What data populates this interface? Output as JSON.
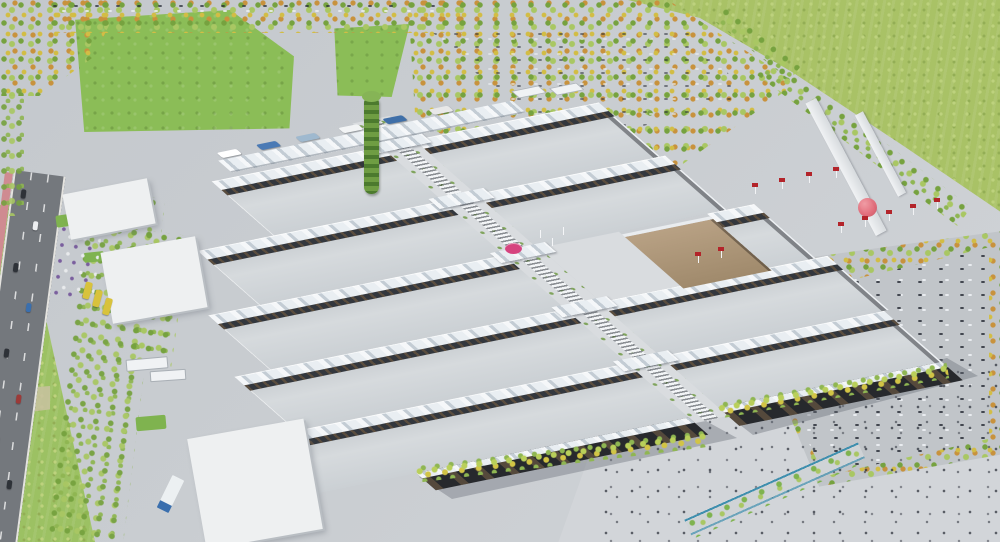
{
  "meta": {
    "type": "architectural aerial rendering",
    "subject": "Oblique aerial rendering of a large exhibition fairground: rows of flat-roofed halls with white wavy canopies along a diagonal central pedestrian spine, a green vertical-garden tower at the north entrance, bus terminal, tree-filled parking groves, access roads with a pink cycle lane, red flag banners and a pink sphere at the east entrance, large pedestrian plaza with people to the south-east, and surrounding green fields",
    "width_px": 1000,
    "height_px": 542
  },
  "palette": {
    "ground": "#c9cdd1",
    "ground_light": "#d2d5d9",
    "road": "#74787d",
    "road_edge": "#e4e3df",
    "bike": "#cf8b91",
    "field": "#a9c266",
    "field_light": "#bdd27d",
    "field_dark": "#93ae55",
    "field_west": "#9cc163",
    "dirt": "#c9c2a0",
    "lawn": "#8bbd57",
    "lawn_small": "#7fb34f",
    "tree1": "#76a23f",
    "tree2": "#a9c763",
    "tree3": "#d2bd45",
    "tree4": "#c8923d",
    "roof_hi": "#d6dadd",
    "roof_lo": "#c2c7cb",
    "wavy_hi": "#f5f7f9",
    "wavy_mid": "#e9eef2",
    "wavy_lo": "#c3ccd4",
    "clere": "#33373d",
    "facade": "#27292d",
    "spine": "#d9dcdf",
    "tan_hi": "#b8a184",
    "tan_lo": "#a08a6c",
    "white_bldg": "#eef0f1",
    "bldg_shade": "#b9bec3",
    "banner": "#b3242a",
    "sphere": "#e2606f",
    "disc": "#d6447f",
    "tower1": "#6f9d43",
    "tower2": "#4c7a2e",
    "tower_cap": "#86b456",
    "water": "#3f8fae",
    "bus_yellow": "#d8c23c",
    "truck_blue": "#3a6fae",
    "shadow": "rgba(100,105,116,0.38)",
    "people": "rgba(45,50,60,0.75)"
  },
  "scene": {
    "regions": [
      "north lawns and tree-lined parking",
      "north-east agricultural field",
      "west boulevard with pink cycle lane and traffic",
      "exhibition hall rows with wavy white canopies",
      "central diagonal pedestrian spine with ribbed glass roof",
      "green vertical-garden tower",
      "central service square with tan building and magenta canopy",
      "east entrance with elevated ramp, red banners and pink sphere",
      "east parking grove with autumn trees",
      "south-east pedestrian plaza with scattered visitors",
      "service warehouses, trucks and yellow shuttle buses on the west side"
    ]
  }
}
